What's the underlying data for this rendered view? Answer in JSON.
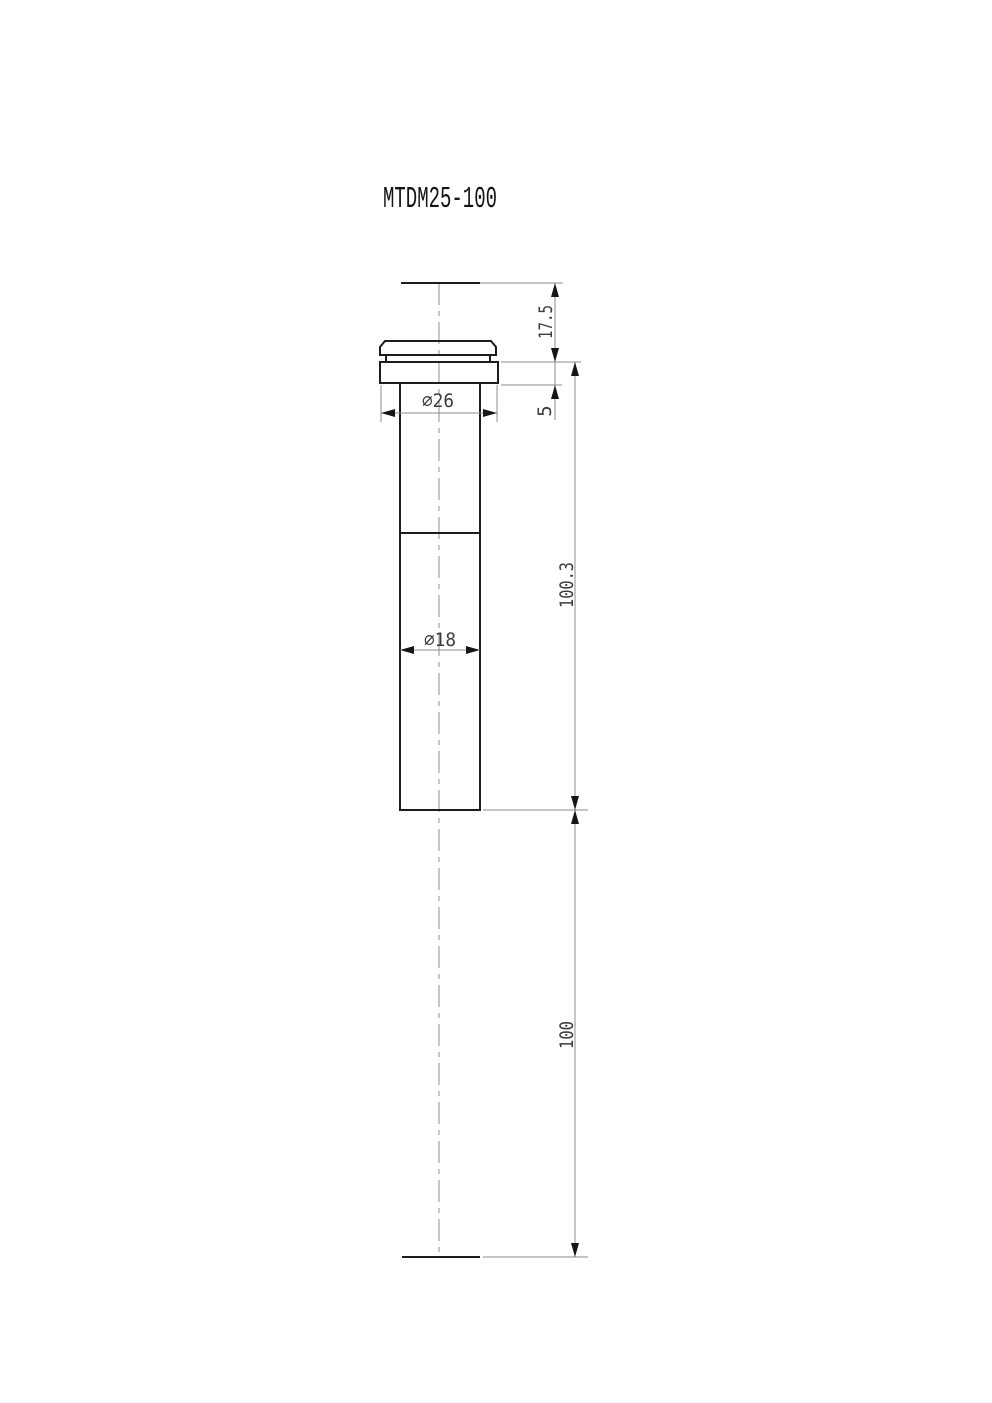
{
  "title": "MTDM25-100",
  "dimensions": {
    "top_extension": "17.5",
    "flange_thickness": "5",
    "upper_section_length": "100.3",
    "travel_length": "100",
    "flange_diameter": "⌀26",
    "rod_diameter": "⌀18"
  },
  "colors": {
    "background": "#ffffff",
    "part-line": "#1d1d1d",
    "thin-line": "#8c8c8c",
    "arrow": "#161616",
    "dim-text": "#3c3c3c",
    "title-text": "#141414"
  }
}
